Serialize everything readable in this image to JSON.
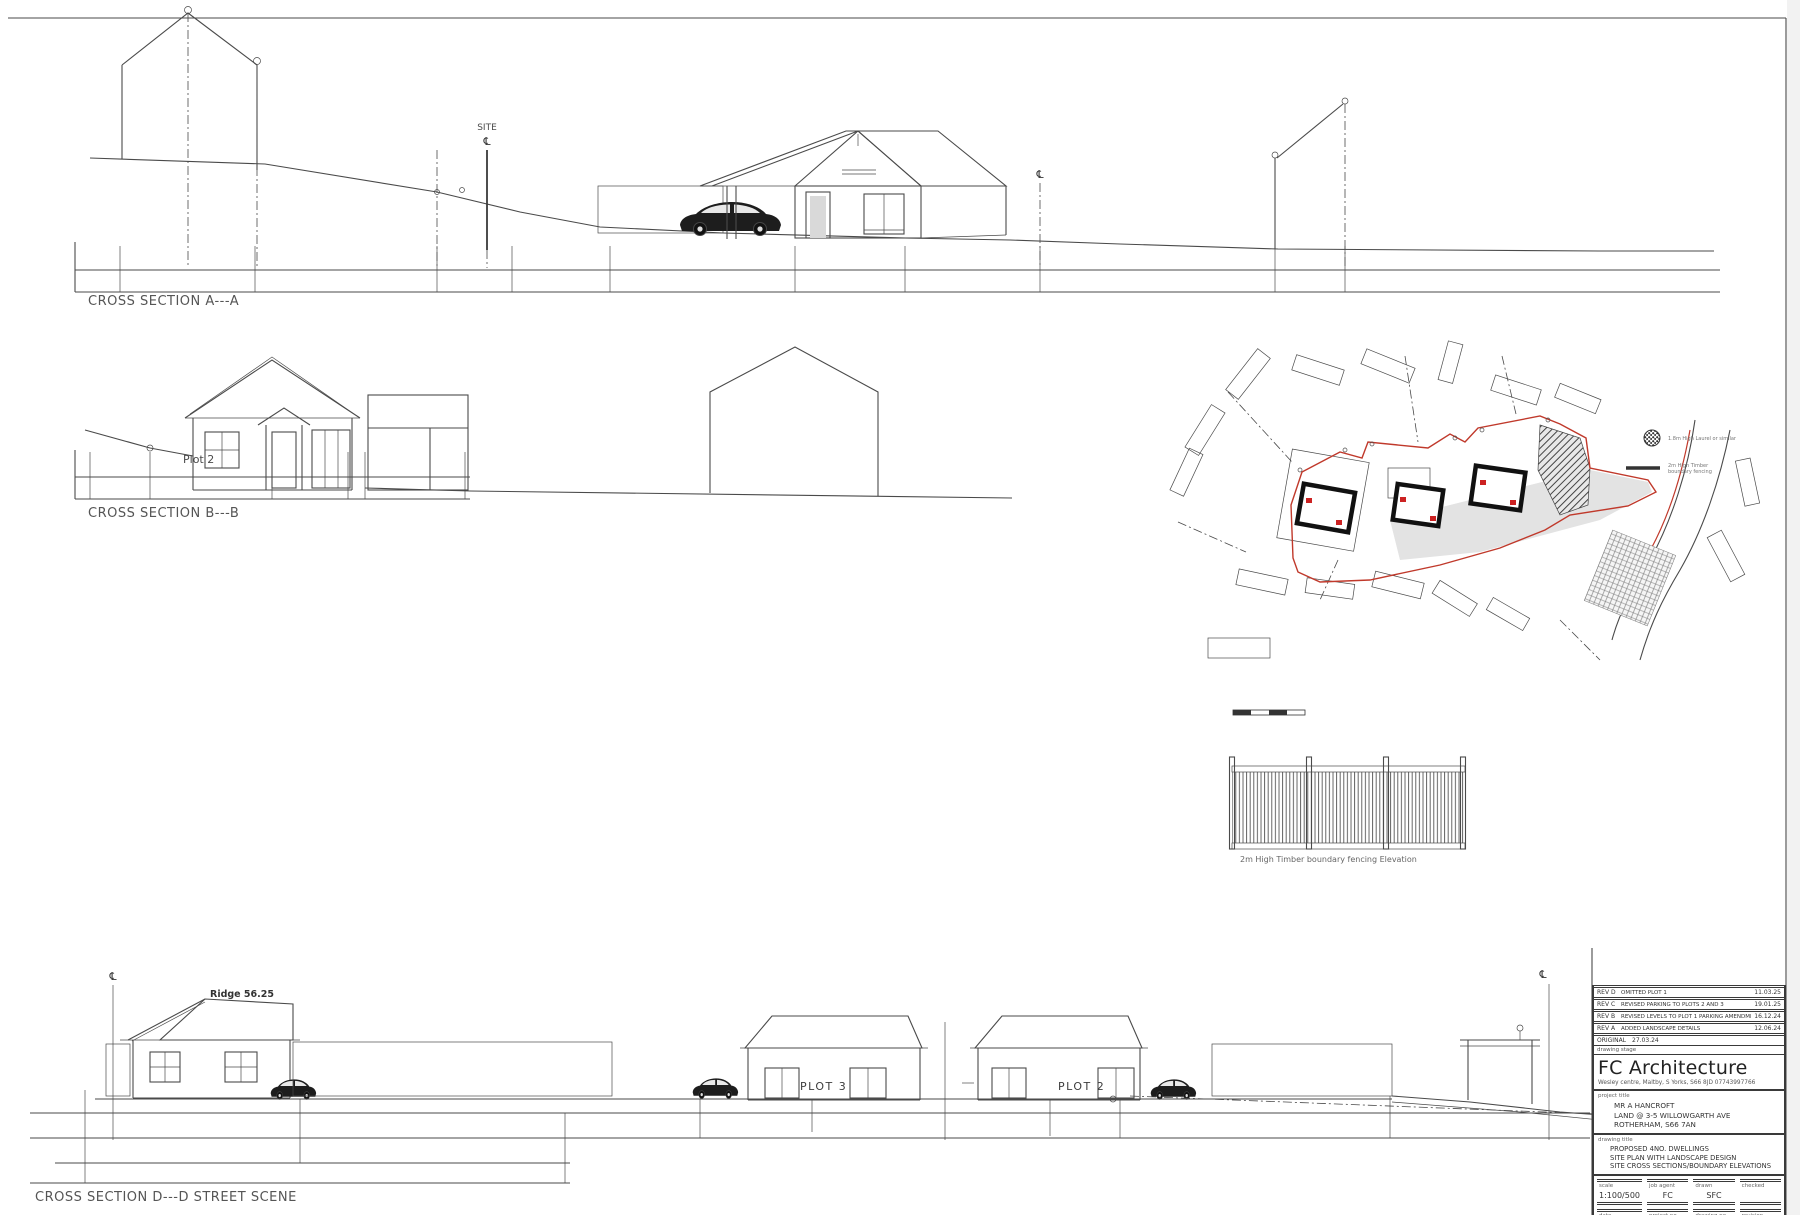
{
  "sheet": {
    "icons": {
      "centerline": "℄"
    },
    "sections": {
      "a": {
        "label": "CROSS SECTION A---A",
        "site_label": "SITE"
      },
      "b": {
        "label": "CROSS SECTION B---B",
        "plot_label": "Plot 2"
      },
      "d": {
        "label": "CROSS SECTION D---D STREET SCENE",
        "ridge_label": "Ridge 56.25",
        "plot3_label": "PLOT 3",
        "plot2_label": "PLOT 2"
      }
    },
    "fence": {
      "label": "2m High Timber boundary fencing Elevation"
    },
    "site_plan": {
      "legend": {
        "laurel": "1.8m High Laurel or similar",
        "fence_line1": "2m High Timber",
        "fence_line2": "boundary fencing"
      }
    }
  },
  "titleblock": {
    "revisions": [
      {
        "rev": "REV D",
        "desc": "OMITTED PLOT 1",
        "date": "11.03.25"
      },
      {
        "rev": "REV C",
        "desc": "REVISED PARKING TO PLOTS 2 AND 3",
        "date": "19.01.25"
      },
      {
        "rev": "REV B",
        "desc": "REVISED LEVELS TO PLOT 1 PARKING AMENDMENTS",
        "date": "16.12.24"
      },
      {
        "rev": "REV A",
        "desc": "ADDED LANDSCAPE DETAILS",
        "date": "12.06.24"
      }
    ],
    "original": {
      "label": "ORIGINAL",
      "date": "27.03.24"
    },
    "stage_label": "drawing stage",
    "firm_name": "FC Architecture",
    "firm_address": "Wesley centre, Maltby, S Yorks, S66 8JD 07743997766",
    "project": {
      "label": "project title",
      "line1": "MR A HANCROFT",
      "line2": "LAND @ 3-5 WILLOWGARTH AVE",
      "line3": "ROTHERHAM, S66 7AN"
    },
    "drawing": {
      "label": "drawing title",
      "line1": "PROPOSED 4NO. DWELLINGS",
      "line2": "SITE PLAN WITH LANDSCAPE DESIGN",
      "line3": "SITE CROSS SECTIONS/BOUNDARY ELEVATIONS"
    },
    "fields": {
      "scale_label": "scale",
      "scale_value": "1:100/500",
      "agent_label": "job agent",
      "agent_value": "FC",
      "drawn_label": "drawn",
      "drawn_value": "SFC",
      "checked_label": "checked",
      "checked_value": "",
      "date_label": "date",
      "date_value": "",
      "project_no_label": "project no.",
      "project_no_value": "",
      "drawing_no_label": "drawing no.",
      "drawing_no_value": "",
      "revision_label": "revision",
      "revision_value": ""
    }
  },
  "colors": {
    "line": "#4a4a4a",
    "boundary_red": "#c0392b",
    "dark": "#1d1d1d"
  }
}
